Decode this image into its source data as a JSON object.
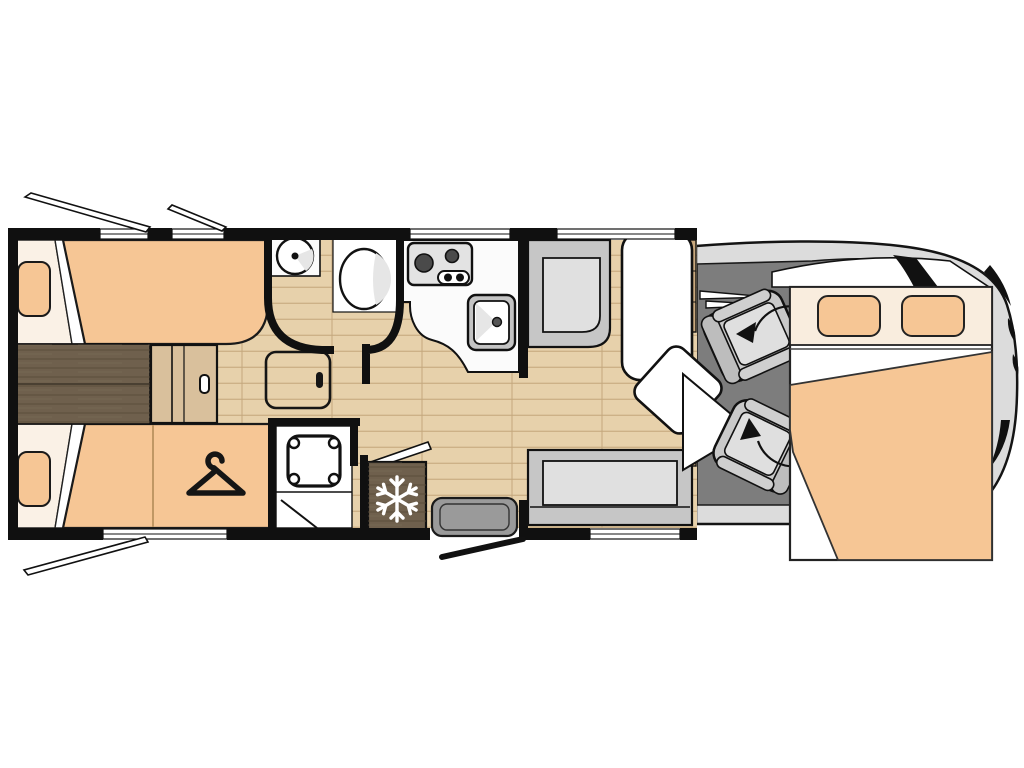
{
  "title": "motorhome-floorplan-top-view",
  "colors": {
    "wall": "#101010",
    "floor": "#e7d1ab",
    "plank_line": "#cdb187",
    "mattress": "#f6c695",
    "linen": "#faf1e6",
    "white": "#ffffff",
    "dark_wood": "#6f604d",
    "dark_wood_grain": "#584a38",
    "light_wood": "#d9c09c",
    "cab_floor": "#7d7d7d",
    "body_gray": "#dcdcdc",
    "bench": "#c6c6c6",
    "bench_seat": "#e0e0e0",
    "seat_outer": "#c9c9c9",
    "seat_back": "#bdbdbd",
    "seat_cushion": "#dfdfdf",
    "steel": "#c4c4c4",
    "counter": "#fbfbfb",
    "hob_plate": "#e3e3e3",
    "burner": "#4a4a4a",
    "entry_step": "#9a9a9a",
    "cabinet": "#c9a97e",
    "headboard": "#f9edde",
    "shading": "#e6e6e6"
  },
  "icons": {
    "wardrobe": "hanger-icon",
    "fridge": "snowflake-icon",
    "cab_seats": "swivel-arrow-icon",
    "windows": "open-flap-icon"
  },
  "rooms": {
    "rear_bedroom": "twin-single-beds",
    "washroom": "washbasin-and-toilet",
    "shower_room": "shower-cubicle",
    "wardrobe": "hanging-wardrobe",
    "kitchen": "hob-sink-fridge",
    "lounge": "bench-seats-with-table",
    "cab": "two-swivel-seats",
    "front_bed": "drop-down-double-bed"
  }
}
